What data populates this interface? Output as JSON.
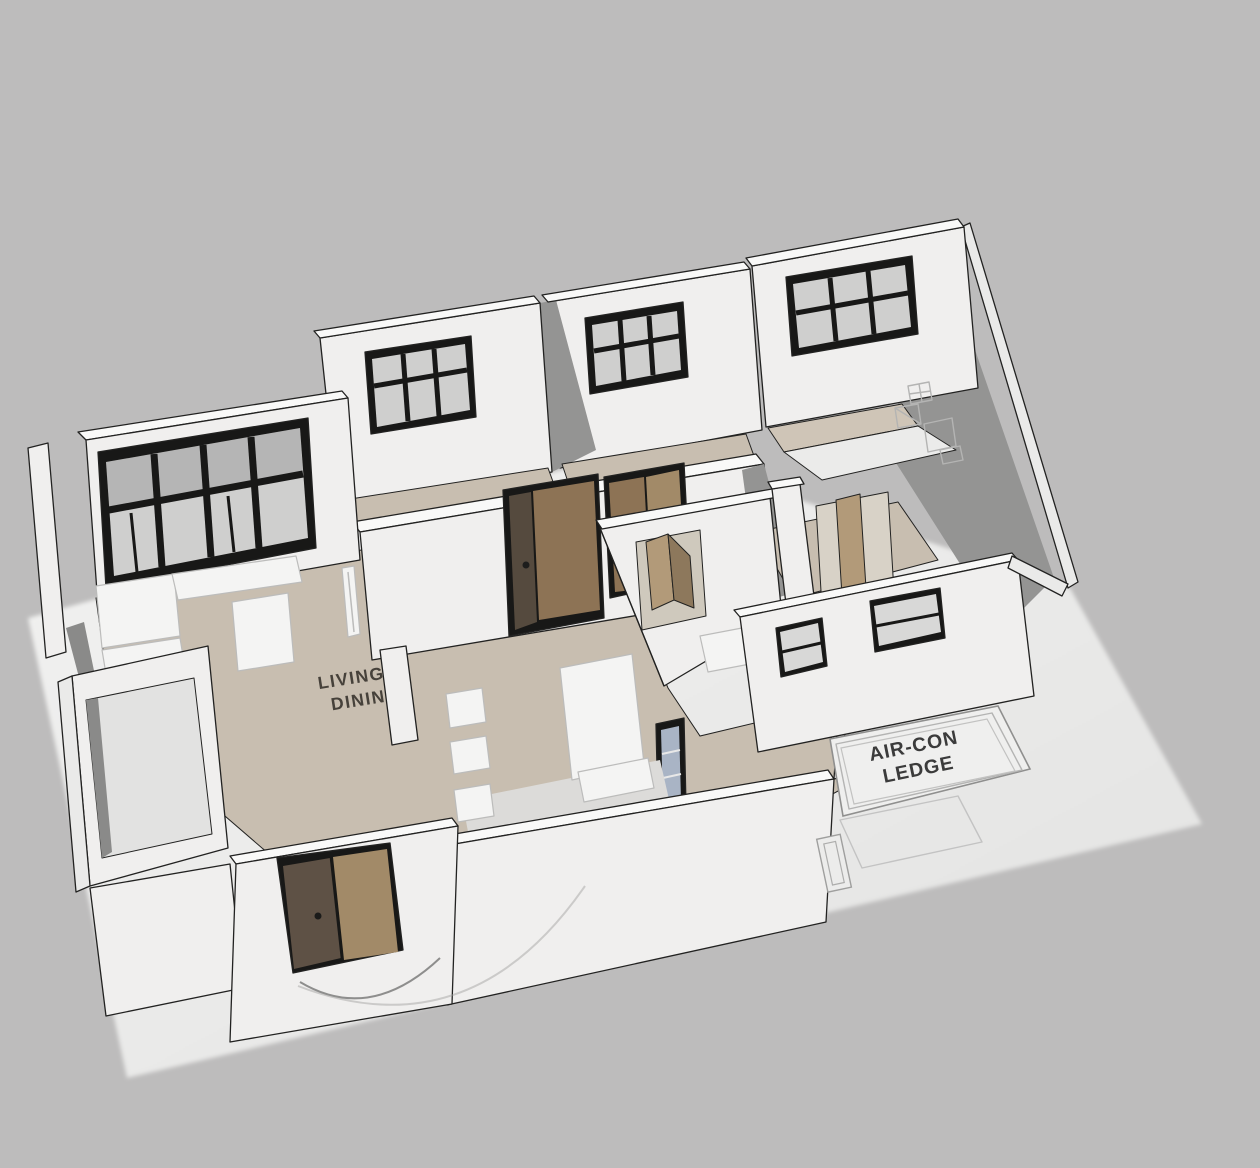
{
  "scene": {
    "title": "3D apartment floor plan model",
    "view": "axonometric-overhead"
  },
  "labels": {
    "living_line1": "LIVING/",
    "living_line2": "DINING",
    "ledge_line1": "AIR-CON",
    "ledge_line2": "LEDGE"
  },
  "colors": {
    "background": "#bdbcbc",
    "ground_plane": "#eeeeed",
    "wall_white": "#f0efee",
    "wall_top_cap": "#f9f9f8",
    "interior_shadow": "#949493",
    "floor_beige": "#c8beb0",
    "floor_white": "#ebebea",
    "window_frame": "#181817",
    "window_glass": "#cfcfce",
    "kitchen_window_glass": "#a9b4c5",
    "door_dark_leaf": "#5e5145",
    "door_light_leaf": "#a28a68",
    "door_open_leaf": "#b29a79",
    "label_text": "#46413a",
    "ledge_text": "#3b3b3b"
  }
}
